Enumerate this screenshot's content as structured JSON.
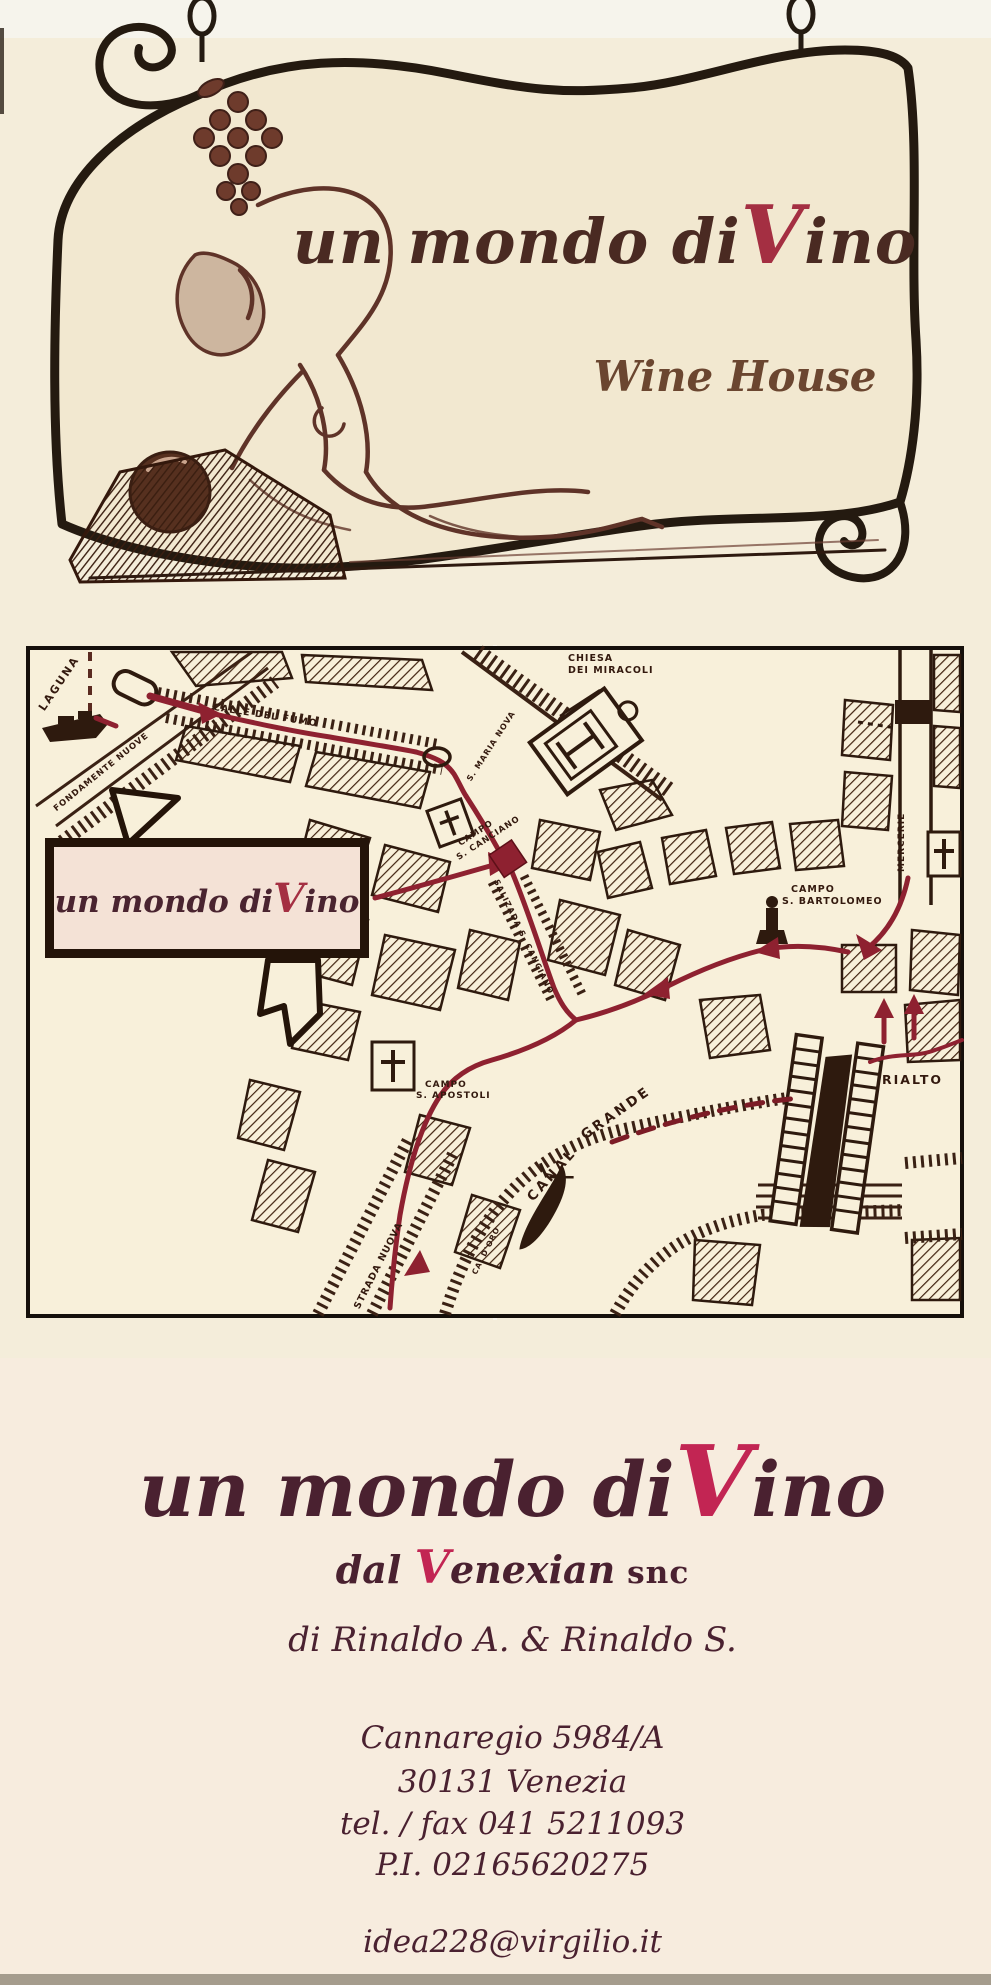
{
  "sign": {
    "title": {
      "prefix": "un mondo di",
      "v": "V",
      "suffix": "ino"
    },
    "subtitle": "Wine House"
  },
  "map": {
    "shop_label": {
      "prefix": "un mondo di",
      "v": "V",
      "suffix": "ino"
    },
    "labels": {
      "laguna": "LAGUNA",
      "fondamente_nuove": "FONDAMENTE NUOVE",
      "calle_del_fumo": "CALLE DEL FUMO",
      "s_maria_nova": "S. MARIA NOVA",
      "chiesa_dei_miracoli": {
        "line1": "CHIESA",
        "line2": "DEI MIRACOLI"
      },
      "campo_s_canciano": {
        "line1": "CAMPO",
        "line2": "S. CANCIANO"
      },
      "salizada_s_canciano": "SALIZADA S. CANCIANO",
      "mercerie": "MERCERIE",
      "campo_s_bartolomeo": {
        "line1": "CAMPO",
        "line2": "S. BARTOLOMEO"
      },
      "rialto": "RIALTO",
      "canal_grande": {
        "word1": "CANAL",
        "word2": "GRANDE"
      },
      "campo_s_apostoli": {
        "line1": "CAMPO",
        "line2": "S. APOSTOLI"
      },
      "strada_nuova": "STRADA NUOVA",
      "ca_doro": "CA' D'ORO"
    }
  },
  "footer": {
    "brand": {
      "prefix": "un mondo di",
      "v": "V",
      "suffix": "ino"
    },
    "tagline": {
      "dal": "dal ",
      "v": "V",
      "rest": "enexian",
      "snc": " snc"
    },
    "owners": "di Rinaldo A. & Rinaldo S.",
    "address_line1": "Cannaregio 5984/A",
    "address_line2": "30131 Venezia",
    "phone": "tel. / fax 041 5211093",
    "vat": "P.I. 02165620275",
    "email": "idea228@virgilio.it"
  },
  "colors": {
    "accent_red": "#c22553",
    "sign_red": "#a42f42",
    "route_red": "#8e2130",
    "ink": "#2a1a0e",
    "maroon_text": "#4a2130",
    "scroll_fill": "#f2e8d0",
    "map_bg": "#f8f0da",
    "box_fill": "#f4e2d6"
  }
}
